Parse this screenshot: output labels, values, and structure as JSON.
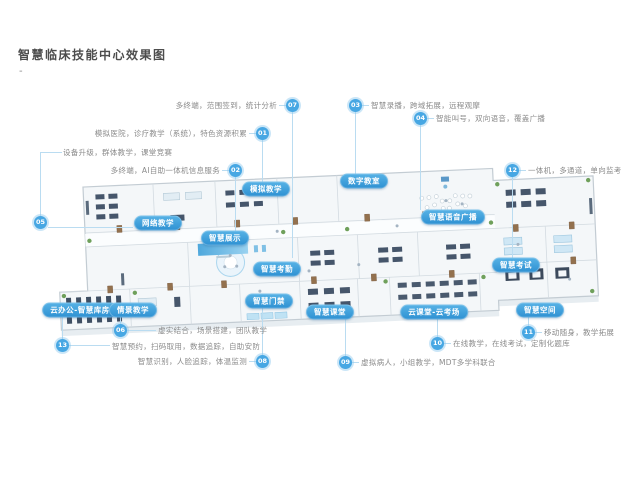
{
  "page": {
    "title": "智慧临床技能中心效果图",
    "dash": "-"
  },
  "colors": {
    "accent_blue": "#3d9bd9",
    "leader_line": "#badcf1",
    "badge_fill": "#47a7e3",
    "label_text": "#8b8b8b",
    "pill_gradient_top": "#58b3e6",
    "pill_gradient_bottom": "#2d90d2",
    "title_text": "#4d4d4d"
  },
  "callouts": [
    {
      "number": "01",
      "text": "模拟医院，诊疗教学（系统），特色资源积累",
      "target": "模拟教学"
    },
    {
      "number": "02",
      "text": "多终端，AI自助一体机信息服务",
      "target": "智慧展示"
    },
    {
      "number": "03",
      "text": "智慧录播，跨域拓展，远程观摩",
      "target": "数字教室"
    },
    {
      "number": "04",
      "text": "智能叫号，双向语音，覆盖广播",
      "target": "智慧语音广播"
    },
    {
      "number": "05",
      "text": "设备升级，群体教学，课堂竞赛",
      "target": "网络教学"
    },
    {
      "number": "06",
      "text": "虚实结合，场景搭建，团队教学",
      "target": "情景教学"
    },
    {
      "number": "07",
      "text": "多终端，范围签到，统计分析",
      "target": "智慧考勤"
    },
    {
      "number": "08",
      "text": "智慧识别，人脸追踪，体温监测",
      "target": "智慧门禁"
    },
    {
      "number": "09",
      "text": "虚拟病人，小组教学，MDT多学科联合",
      "target": "智慧课堂"
    },
    {
      "number": "10",
      "text": "在线教学，在线考试，定制化题库",
      "target": "云课堂-云考场"
    },
    {
      "number": "11",
      "text": "移动随身，教学拓展",
      "target": "智慧空间"
    },
    {
      "number": "12",
      "text": "一体机，多通道，单向监考",
      "target": "智慧考试"
    },
    {
      "number": "13",
      "text": "智慧预约，扫码取用，数据追踪，自助安防",
      "target": "云办公-智慧库房"
    }
  ],
  "tags": [
    {
      "label": "网络教学"
    },
    {
      "label": "模拟教学"
    },
    {
      "label": "数字教室"
    },
    {
      "label": "智慧语音广播"
    },
    {
      "label": "智慧展示"
    },
    {
      "label": "智慧考勤"
    },
    {
      "label": "智慧考试"
    },
    {
      "label": "智慧门禁"
    },
    {
      "label": "云办公-智慧库房"
    },
    {
      "label": "情景教学"
    },
    {
      "label": "智慧课堂"
    },
    {
      "label": "云课堂-云考场"
    },
    {
      "label": "智慧空间"
    }
  ]
}
